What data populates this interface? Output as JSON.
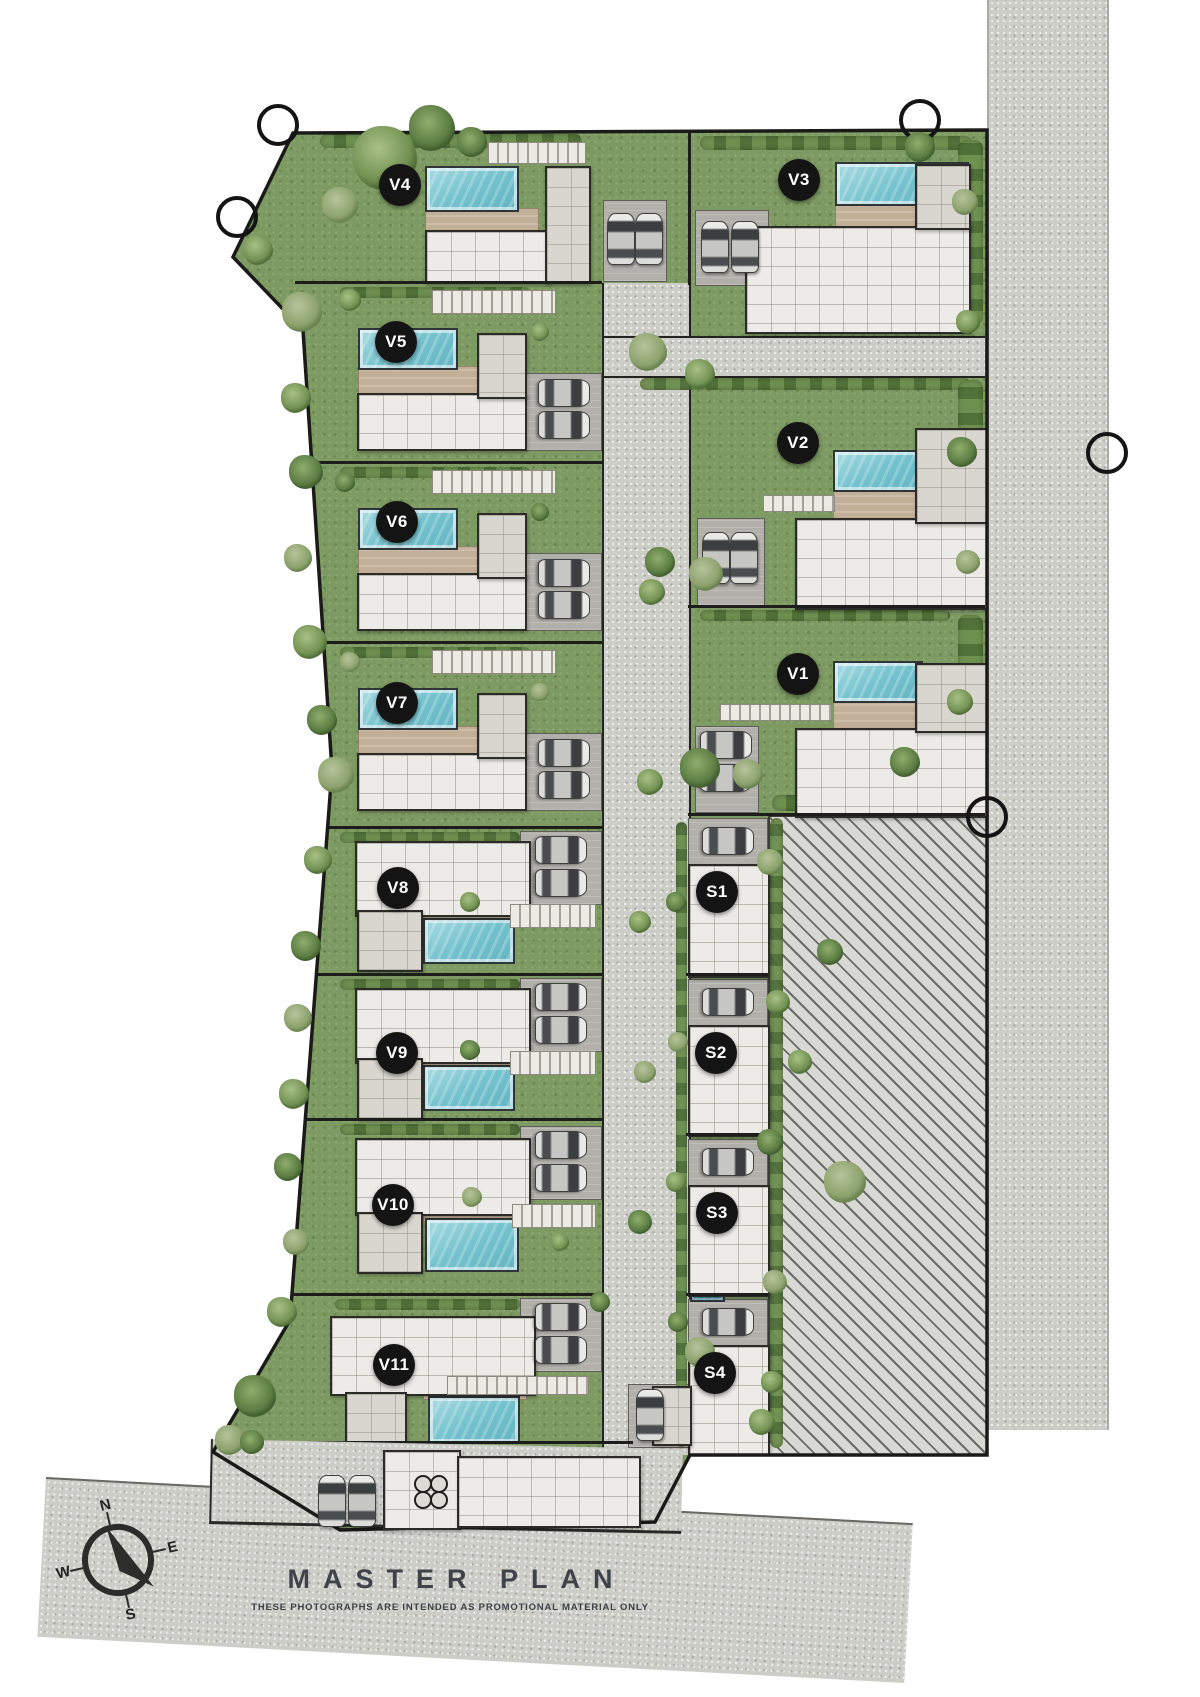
{
  "title": {
    "text": "MASTER PLAN",
    "subtitle": "THESE PHOTOGRAPHS ARE INTENDED AS PROMOTIONAL MATERIAL ONLY"
  },
  "compass": {
    "north": "N",
    "east": "E",
    "south": "S",
    "west": "W"
  },
  "units": [
    {
      "label": "V1",
      "type": "villa"
    },
    {
      "label": "V2",
      "type": "villa"
    },
    {
      "label": "V3",
      "type": "villa"
    },
    {
      "label": "V4",
      "type": "villa"
    },
    {
      "label": "V5",
      "type": "villa"
    },
    {
      "label": "V6",
      "type": "villa"
    },
    {
      "label": "V7",
      "type": "villa"
    },
    {
      "label": "V8",
      "type": "villa"
    },
    {
      "label": "V9",
      "type": "villa"
    },
    {
      "label": "V10",
      "type": "villa"
    },
    {
      "label": "V11",
      "type": "villa"
    },
    {
      "label": "S1",
      "type": "suite"
    },
    {
      "label": "S2",
      "type": "suite"
    },
    {
      "label": "S3",
      "type": "suite"
    },
    {
      "label": "S4",
      "type": "suite"
    }
  ],
  "colors": {
    "grass": "#7d9a62",
    "road": "#cdcdc8",
    "villa_pool": "#74c2ce",
    "suite_pool": "#3c97ac",
    "terrace": "#c2af97",
    "badge": "#141414",
    "boundary_line": "#1d1d1b"
  }
}
